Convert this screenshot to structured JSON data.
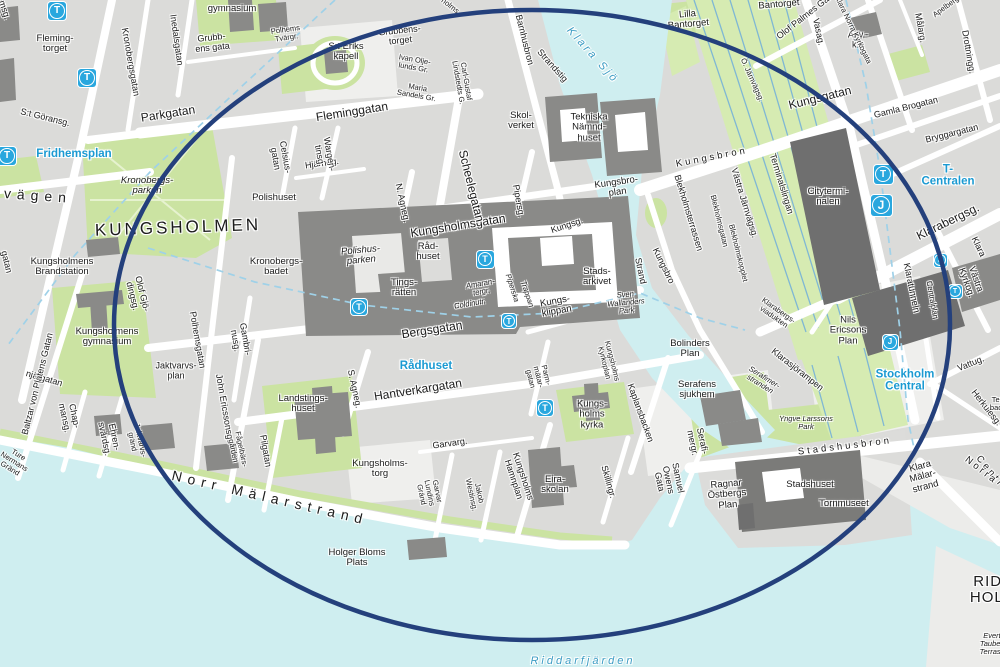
{
  "map": {
    "description": "Street map of central Stockholm: Kungsholmen and the Central Station area, with a dark blue ellipse annotation circling the district",
    "colors": {
      "water": "#cfeef0",
      "park": "#cbe3a2",
      "railway_park": "#d6ebb2",
      "city_block": "#dbdbd9",
      "street": "#ffffff",
      "building": "#8a8a88",
      "building_dark": "#6f6f6f",
      "highlight_ellipse": "#24407c",
      "metro_blue": "#29a7de",
      "station_label_blue": "#1b9ad2",
      "water_label_blue": "#3d9dc4",
      "rail_line": "#7fb7d4",
      "boundary_dash": "#9fd1e8"
    },
    "highlight": {
      "shape": "ellipse",
      "cx": 532,
      "cy": 325,
      "rx": 418,
      "ry": 315
    },
    "stations": [
      {
        "type": "T",
        "x": 57,
        "y": 11,
        "s": 18
      },
      {
        "type": "T",
        "x": 87,
        "y": 78,
        "s": 18
      },
      {
        "type": "T",
        "x": 7,
        "y": 156,
        "s": 18
      },
      {
        "type": "T",
        "x": 359,
        "y": 307,
        "s": 16
      },
      {
        "type": "T",
        "x": 485,
        "y": 259,
        "s": 17
      },
      {
        "type": "T",
        "x": 509,
        "y": 321,
        "s": 14
      },
      {
        "type": "T",
        "x": 545,
        "y": 408,
        "s": 16
      },
      {
        "type": "T",
        "x": 883,
        "y": 174,
        "s": 19
      },
      {
        "type": "T",
        "x": 955,
        "y": 291,
        "s": 13
      },
      {
        "type": "J",
        "x": 881,
        "y": 205,
        "s": 21
      },
      {
        "type": "J",
        "x": 940,
        "y": 260,
        "s": 13
      },
      {
        "type": "J",
        "x": 890,
        "y": 342,
        "s": 15
      }
    ],
    "labels": [
      {
        "t": "Fridhemsg.",
        "x": 0,
        "y": -2,
        "r": 72,
        "c": "st"
      },
      {
        "t": "Kronobergsgatan",
        "x": 130,
        "y": 62,
        "r": 80,
        "c": "st"
      },
      {
        "t": "Inedalsgatan",
        "x": 176,
        "y": 40,
        "r": 82,
        "c": "st"
      },
      {
        "t": "gymnasium",
        "x": 232,
        "y": 9,
        "r": 0,
        "c": "pl"
      },
      {
        "t": "Grubb-\nens gata",
        "x": 212,
        "y": 43,
        "r": -6,
        "c": "st"
      },
      {
        "t": "Polhems\nTvärgr.",
        "x": 286,
        "y": 34,
        "r": -8,
        "c": "st8"
      },
      {
        "t": "S:t Eriks\nkapell",
        "x": 346,
        "y": 52,
        "r": 0,
        "c": "pl"
      },
      {
        "t": "Grubbens-\ntorget",
        "x": 400,
        "y": 36,
        "r": -6,
        "c": "st"
      },
      {
        "t": "Ivan Olje-\nlunds Gr.",
        "x": 414,
        "y": 64,
        "r": 10,
        "c": "st8"
      },
      {
        "t": "Maria\nSandels Gr.",
        "x": 417,
        "y": 92,
        "r": 10,
        "c": "st8"
      },
      {
        "t": "Carl-Gustaf\nLindstedts G.",
        "x": 462,
        "y": 82,
        "r": 80,
        "c": "st8"
      },
      {
        "t": "Barnhusbron",
        "x": 524,
        "y": 40,
        "r": 76,
        "c": "st"
      },
      {
        "t": "holms",
        "x": 450,
        "y": 6,
        "r": 38,
        "c": "st8"
      },
      {
        "t": "Strandstig",
        "x": 552,
        "y": 66,
        "r": 48,
        "c": "st"
      },
      {
        "t": "Klara Sjö",
        "x": 592,
        "y": 56,
        "r": 48,
        "c": "wat"
      },
      {
        "t": "Skol-\nverket",
        "x": 521,
        "y": 121,
        "r": 0,
        "c": "pl"
      },
      {
        "t": "Tekniska\nNämnd-\nhuset",
        "x": 589,
        "y": 128,
        "r": 0,
        "c": "pl"
      },
      {
        "t": "Fleminggatan",
        "x": 352,
        "y": 112,
        "r": -9,
        "c": "st2"
      },
      {
        "t": "Parkgatan",
        "x": 168,
        "y": 114,
        "r": -9,
        "c": "st2"
      },
      {
        "t": "Hjärneg.",
        "x": 322,
        "y": 164,
        "r": -8,
        "c": "st"
      },
      {
        "t": "Wargen-\ntinsg.",
        "x": 324,
        "y": 155,
        "r": 80,
        "c": "st"
      },
      {
        "t": "Celsius-\ngatan",
        "x": 280,
        "y": 158,
        "r": 80,
        "c": "st"
      },
      {
        "t": "Kronobergs-\nparken",
        "x": 147,
        "y": 186,
        "r": 0,
        "c": "pli"
      },
      {
        "t": "S:t Göransg.",
        "x": 45,
        "y": 118,
        "r": 14,
        "c": "st"
      },
      {
        "t": "Fridhemsplan",
        "x": 74,
        "y": 154,
        "r": 0,
        "c": "stn"
      },
      {
        "t": "vägen",
        "x": 38,
        "y": 196,
        "r": 4,
        "c": "sp"
      },
      {
        "t": "Fleming-\ntorget",
        "x": 55,
        "y": 44,
        "r": 0,
        "c": "pl"
      },
      {
        "t": "KUNGSHOLMEN",
        "x": 178,
        "y": 228,
        "r": -2,
        "c": "cap"
      },
      {
        "t": "Polishuset",
        "x": 274,
        "y": 198,
        "r": 0,
        "c": "pl"
      },
      {
        "t": "Kronobergs-\nbadet",
        "x": 276,
        "y": 267,
        "r": 0,
        "c": "pl"
      },
      {
        "t": "Polishus-\nparken",
        "x": 361,
        "y": 256,
        "r": -5,
        "c": "pli"
      },
      {
        "t": "Råd-\nhuset",
        "x": 428,
        "y": 252,
        "r": 0,
        "c": "pl"
      },
      {
        "t": "Tings-\nrätten",
        "x": 404,
        "y": 288,
        "r": 0,
        "c": "pl"
      },
      {
        "t": "Kungsholmens\nBrandstation",
        "x": 62,
        "y": 267,
        "r": 0,
        "c": "pl"
      },
      {
        "t": "Kungsholmens\ngymnasium",
        "x": 107,
        "y": 337,
        "r": 0,
        "c": "pl"
      },
      {
        "t": "Olof Gjö-\ndingsg.",
        "x": 137,
        "y": 295,
        "r": 76,
        "c": "st"
      },
      {
        "t": "Polhemsgatan",
        "x": 197,
        "y": 340,
        "r": 80,
        "c": "st"
      },
      {
        "t": "Gambri-\nnusg.",
        "x": 240,
        "y": 340,
        "r": 80,
        "c": "st"
      },
      {
        "t": "Jaktvarvs-\nplan",
        "x": 176,
        "y": 371,
        "r": 0,
        "c": "st"
      },
      {
        "t": "Ture\nNermans\nGränd",
        "x": 14,
        "y": 462,
        "r": 32,
        "c": "st8"
      },
      {
        "t": "njärgatan",
        "x": 44,
        "y": 379,
        "r": 16,
        "c": "st"
      },
      {
        "t": "Baltzar von Platens Gatan",
        "x": 38,
        "y": 384,
        "r": -76,
        "c": "st"
      },
      {
        "t": "Jaktvarvs-\ngränd",
        "x": 136,
        "y": 441,
        "r": 78,
        "c": "st8"
      },
      {
        "t": "Chap-\nmansg.",
        "x": 69,
        "y": 417,
        "r": 78,
        "c": "st"
      },
      {
        "t": "Ehren-\nsvärdsg.",
        "x": 109,
        "y": 438,
        "r": 78,
        "c": "st"
      },
      {
        "t": "John Ericssonsg.",
        "x": 224,
        "y": 408,
        "r": 80,
        "c": "st"
      },
      {
        "t": "Fågelbärs-\ngården",
        "x": 237,
        "y": 450,
        "r": 78,
        "c": "st8"
      },
      {
        "t": "Pilgatan",
        "x": 265,
        "y": 451,
        "r": 80,
        "c": "st"
      },
      {
        "t": "Landstings-\nhuset",
        "x": 303,
        "y": 404,
        "r": 0,
        "c": "pl"
      },
      {
        "t": "S. Agneg.",
        "x": 354,
        "y": 389,
        "r": 78,
        "c": "st"
      },
      {
        "t": "Hantverkargatan",
        "x": 418,
        "y": 390,
        "r": -9,
        "c": "st2"
      },
      {
        "t": "Rådhuset",
        "x": 426,
        "y": 366,
        "r": 0,
        "c": "stn"
      },
      {
        "t": "Kungsholms-\ntorg",
        "x": 380,
        "y": 469,
        "r": 0,
        "c": "pl"
      },
      {
        "t": "Garvarg.",
        "x": 450,
        "y": 444,
        "r": -8,
        "c": "st"
      },
      {
        "t": "Garvar\nLundins\nGränd",
        "x": 429,
        "y": 493,
        "r": 78,
        "c": "st8"
      },
      {
        "t": "Jakob\nWestinsg.",
        "x": 475,
        "y": 494,
        "r": 78,
        "c": "st8"
      },
      {
        "t": "Kungsholms\nHamnplan",
        "x": 518,
        "y": 478,
        "r": 72,
        "c": "st"
      },
      {
        "t": "Eira-\nskolan",
        "x": 555,
        "y": 485,
        "r": 0,
        "c": "pl"
      },
      {
        "t": "Parm-\nmätar-\ngatan",
        "x": 538,
        "y": 377,
        "r": 76,
        "c": "st8"
      },
      {
        "t": "Kungsholms\nKyrkoplan",
        "x": 608,
        "y": 362,
        "r": 76,
        "c": "st8"
      },
      {
        "t": "Kungs-\nholms\nkyrka",
        "x": 592,
        "y": 415,
        "r": 0,
        "c": "pl"
      },
      {
        "t": "Skillingr.",
        "x": 608,
        "y": 482,
        "r": 74,
        "c": "st"
      },
      {
        "t": "Kaplansbacken",
        "x": 640,
        "y": 413,
        "r": 70,
        "c": "st"
      },
      {
        "t": "Samuel\nOwens\nGata",
        "x": 668,
        "y": 480,
        "r": 78,
        "c": "st"
      },
      {
        "t": "Serafi-\nmergr.",
        "x": 697,
        "y": 442,
        "r": 78,
        "c": "st"
      },
      {
        "t": "Bergsgatan",
        "x": 432,
        "y": 330,
        "r": -9,
        "c": "st2"
      },
      {
        "t": "N. Agneg.",
        "x": 402,
        "y": 203,
        "r": 78,
        "c": "st"
      },
      {
        "t": "Kungsholmsgatan",
        "x": 458,
        "y": 226,
        "r": -9,
        "c": "st2"
      },
      {
        "t": "Scheelegatan",
        "x": 471,
        "y": 186,
        "r": 76,
        "c": "st2"
      },
      {
        "t": "Pipersg.",
        "x": 518,
        "y": 201,
        "r": 80,
        "c": "st"
      },
      {
        "t": "Kungsg.",
        "x": 567,
        "y": 226,
        "r": -18,
        "c": "st"
      },
      {
        "t": "Kungsbro-\nplan",
        "x": 617,
        "y": 188,
        "r": -8,
        "c": "pl"
      },
      {
        "t": "Amaran-\ntergr.",
        "x": 481,
        "y": 288,
        "r": -10,
        "c": "st8i"
      },
      {
        "t": "Coldinutr.",
        "x": 470,
        "y": 304,
        "r": -10,
        "c": "st8i"
      },
      {
        "t": "Piperska",
        "x": 512,
        "y": 288,
        "r": 72,
        "c": "st8i"
      },
      {
        "t": "Trappan",
        "x": 527,
        "y": 294,
        "r": 72,
        "c": "st8i"
      },
      {
        "t": "Kungs-\nklippan",
        "x": 556,
        "y": 307,
        "r": -10,
        "c": "pl"
      },
      {
        "t": "Stads-\narkivet",
        "x": 597,
        "y": 277,
        "r": 0,
        "c": "pl"
      },
      {
        "t": "Strand",
        "x": 640,
        "y": 271,
        "r": 78,
        "c": "st"
      },
      {
        "t": "Kungsbro",
        "x": 663,
        "y": 266,
        "r": 64,
        "c": "st"
      },
      {
        "t": "Sven\nWallanders\nPark",
        "x": 626,
        "y": 303,
        "r": -5,
        "c": "pls"
      },
      {
        "t": "Blekholmsterrassen",
        "x": 688,
        "y": 213,
        "r": 73,
        "c": "st"
      },
      {
        "t": "Blekholmsgatan",
        "x": 719,
        "y": 221,
        "r": 76,
        "c": "st8"
      },
      {
        "t": "Blekholmskopplet",
        "x": 738,
        "y": 253,
        "r": 76,
        "c": "st8"
      },
      {
        "t": "Västra Järnvägsg.",
        "x": 744,
        "y": 203,
        "r": 73,
        "c": "st"
      },
      {
        "t": "Terminalslingan",
        "x": 781,
        "y": 184,
        "r": 73,
        "c": "st"
      },
      {
        "t": "Klarabergs-\nviadukten",
        "x": 776,
        "y": 314,
        "r": 35,
        "c": "st8"
      },
      {
        "t": "Kungsbron",
        "x": 712,
        "y": 158,
        "r": -11,
        "c": "sp2"
      },
      {
        "t": "Kungsgatan",
        "x": 820,
        "y": 98,
        "r": -14,
        "c": "st2"
      },
      {
        "t": "Lilla\nBantorget",
        "x": 688,
        "y": 20,
        "r": -5,
        "c": "pl"
      },
      {
        "t": "Bantorget",
        "x": 779,
        "y": 5,
        "r": -5,
        "c": "pl"
      },
      {
        "t": "Olof Palmes Gata",
        "x": 806,
        "y": 16,
        "r": -38,
        "c": "st"
      },
      {
        "t": "Ö. Järnvägsg.",
        "x": 752,
        "y": 80,
        "r": 66,
        "c": "st8"
      },
      {
        "t": "Vasag.",
        "x": 818,
        "y": 32,
        "r": 78,
        "c": "st"
      },
      {
        "t": "Adv.-\nk:n",
        "x": 858,
        "y": 40,
        "r": 0,
        "c": "st"
      },
      {
        "t": "Klara Norra Kyrkogata",
        "x": 853,
        "y": 30,
        "r": 64,
        "c": "st8"
      },
      {
        "t": "Målarg.",
        "x": 920,
        "y": 28,
        "r": 80,
        "c": "st"
      },
      {
        "t": "Apelbergsg.",
        "x": 950,
        "y": 4,
        "r": -36,
        "c": "st8"
      },
      {
        "t": "Drottningg.",
        "x": 968,
        "y": 52,
        "r": 80,
        "c": "st"
      },
      {
        "t": "Gamla Brogatan",
        "x": 906,
        "y": 108,
        "r": -14,
        "c": "st"
      },
      {
        "t": "Bryggargatan",
        "x": 952,
        "y": 134,
        "r": -14,
        "c": "st"
      },
      {
        "t": "T-Centralen",
        "x": 948,
        "y": 176,
        "r": 0,
        "c": "stn"
      },
      {
        "t": "Citytermi-\nnalen",
        "x": 828,
        "y": 197,
        "r": 0,
        "c": "pl"
      },
      {
        "t": "Klarabergsg.",
        "x": 948,
        "y": 222,
        "r": -26,
        "c": "st2"
      },
      {
        "t": "Klara",
        "x": 978,
        "y": 247,
        "r": 64,
        "c": "st"
      },
      {
        "t": "Västra Kyrkog.",
        "x": 971,
        "y": 281,
        "r": 70,
        "c": "st"
      },
      {
        "t": "Nils\nEricsons\nPlan",
        "x": 848,
        "y": 331,
        "r": 0,
        "c": "pl"
      },
      {
        "t": "Stockholm\nCentral",
        "x": 905,
        "y": 381,
        "r": 0,
        "c": "stn"
      },
      {
        "t": "Klaratunneln",
        "x": 911,
        "y": 288,
        "r": 78,
        "c": "st"
      },
      {
        "t": "Centralplan",
        "x": 932,
        "y": 300,
        "r": 80,
        "c": "st8"
      },
      {
        "t": "Vattug.",
        "x": 971,
        "y": 364,
        "r": -22,
        "c": "st"
      },
      {
        "t": "Herkulesg.",
        "x": 986,
        "y": 408,
        "r": 52,
        "c": "st"
      },
      {
        "t": "Tegel-\nbacken",
        "x": 1002,
        "y": 404,
        "r": 0,
        "c": "st8"
      },
      {
        "t": "Centralbron",
        "x": 1004,
        "y": 489,
        "r": 50,
        "c": "sp2"
      },
      {
        "t": "Norra",
        "x": 981,
        "y": 471,
        "r": 38,
        "c": "sp2"
      },
      {
        "t": "Klara\nMälar-\nstrand",
        "x": 923,
        "y": 477,
        "r": -15,
        "c": "pl"
      },
      {
        "t": "Stadshusbron",
        "x": 845,
        "y": 447,
        "r": -7,
        "c": "sp2"
      },
      {
        "t": "Yngve Larssons\nPark",
        "x": 806,
        "y": 423,
        "r": 0,
        "c": "pls"
      },
      {
        "t": "Serafimer-\nstranden",
        "x": 762,
        "y": 381,
        "r": 32,
        "c": "st8i"
      },
      {
        "t": "Klarasjörampen",
        "x": 797,
        "y": 370,
        "r": 38,
        "c": "st"
      },
      {
        "t": "Bolinders\nPlan",
        "x": 690,
        "y": 349,
        "r": 0,
        "c": "pl"
      },
      {
        "t": "Serafens\nsjukhem",
        "x": 697,
        "y": 390,
        "r": 0,
        "c": "pl"
      },
      {
        "t": "Ragnar\nÖstbergs\nPlan",
        "x": 727,
        "y": 495,
        "r": -5,
        "c": "pl"
      },
      {
        "t": "Stadshuset",
        "x": 810,
        "y": 485,
        "r": 0,
        "c": "pl"
      },
      {
        "t": "Tornmuseet",
        "x": 844,
        "y": 504,
        "r": 0,
        "c": "pl"
      },
      {
        "t": "Holger Bloms\nPlats",
        "x": 357,
        "y": 558,
        "r": 0,
        "c": "pl"
      },
      {
        "t": "Norr Mälarstrand",
        "x": 270,
        "y": 498,
        "r": 13,
        "c": "sp"
      },
      {
        "t": "Riddarfjärden",
        "x": 583,
        "y": 662,
        "r": 0,
        "c": "wat"
      },
      {
        "t": "RIDDAR\nHOLMEN",
        "x": 1005,
        "y": 590,
        "r": 0,
        "c": "big2"
      },
      {
        "t": "Evert\nTaubes\nTerrass",
        "x": 992,
        "y": 644,
        "r": 0,
        "c": "st8i"
      },
      {
        "t": "gatan",
        "x": 6,
        "y": 262,
        "r": 76,
        "c": "st"
      }
    ]
  }
}
